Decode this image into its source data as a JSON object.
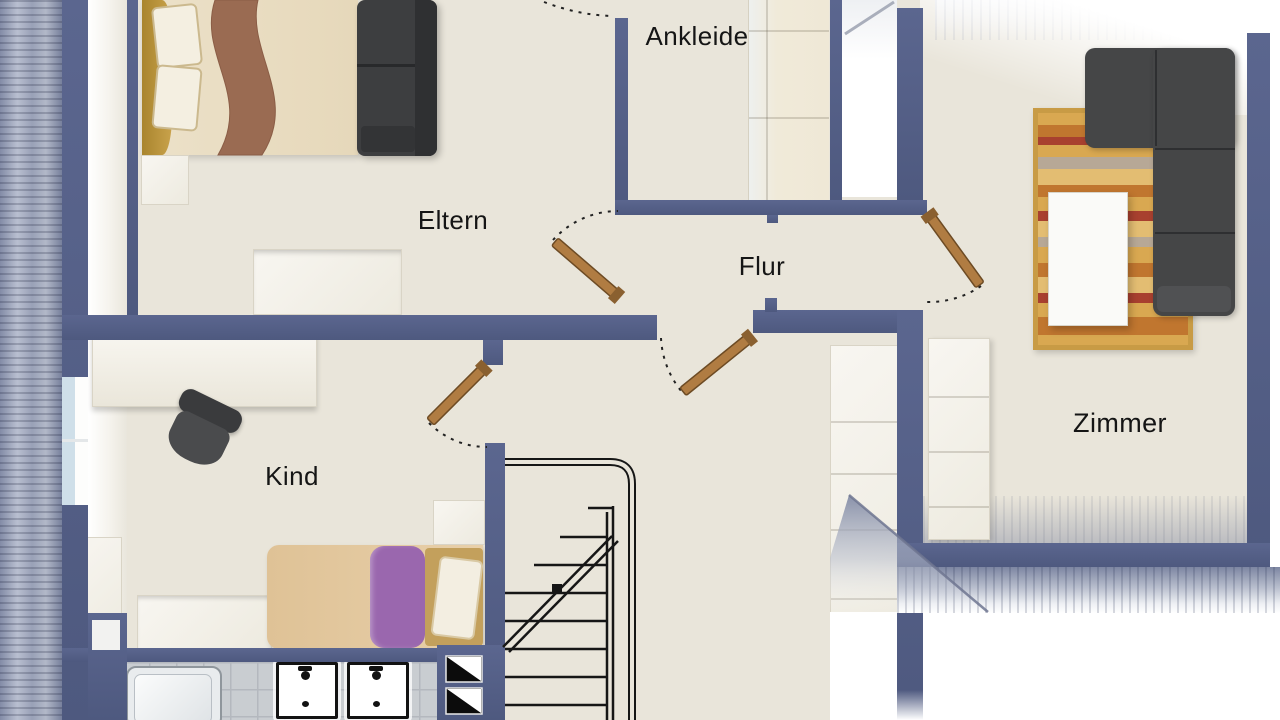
{
  "plan": {
    "title": "Dachgeschoss Grundriss",
    "rooms": {
      "eltern": {
        "label": "Eltern"
      },
      "ankleide": {
        "label": "Ankleide"
      },
      "flur": {
        "label": "Flur"
      },
      "kind": {
        "label": "Kind"
      },
      "zimmer": {
        "label": "Zimmer"
      }
    },
    "palette": {
      "wall": "#545f86",
      "floor": "#e9e5da",
      "door_leaf": "#b07c42",
      "roof_dark": "#77809c",
      "roof_light": "#c6cbd8",
      "bath_tile": "#c9cdd1",
      "sofa_dark": "#454647",
      "rug_gold": "#d9a851",
      "duvet_purple": "#9a67ae"
    },
    "fixtures": {
      "eltern": [
        "double-bed",
        "dark-sofa",
        "nightstand",
        "dresser"
      ],
      "ankleide": [
        "wardrobe-closet"
      ],
      "zimmer": [
        "corner-sofa",
        "striped-rug",
        "coffee-table",
        "shelf"
      ],
      "kind": [
        "desk",
        "office-chair",
        "single-bed",
        "sideboard",
        "cabinet",
        "nightstand"
      ],
      "bath": [
        "bathtub",
        "sink",
        "sink"
      ],
      "hall": [
        "staircase",
        "wardrobe",
        "chimney-flues"
      ]
    }
  }
}
